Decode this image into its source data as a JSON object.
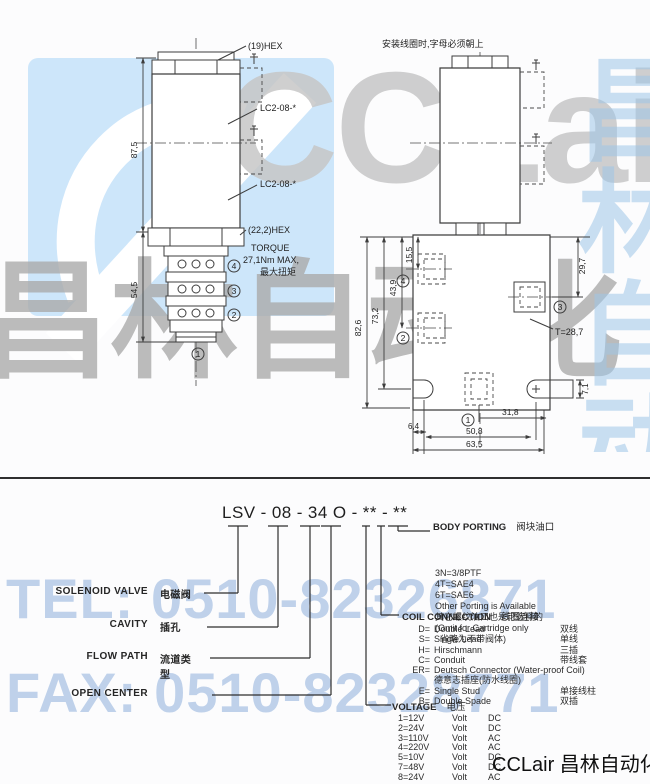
{
  "watermark": {
    "brand_latin": "CCLair",
    "brand_cn": "昌林自动化",
    "tel": "TEL: 0510-82326871",
    "fax": "FAX: 0510-82328771",
    "footer_brand": "CCLair 昌林自动化",
    "colors": {
      "logo_blue": "#cde6fa",
      "gray": "#c7c7c7",
      "blue_text": "#b9cde9"
    }
  },
  "drawings": {
    "install_note": "安装线圈时,字母必须朝上",
    "left": {
      "hex_top": "(19)HEX",
      "cavity_label_1": "LC2-08-*",
      "cavity_label_2": "LC2-08-*",
      "dim_coil_height": "87,5",
      "dim_cartridge_height": "54,5",
      "hex_bottom": "(22,2)HEX",
      "torque_line1": "TORQUE",
      "torque_line2": "27,1Nm MAX,",
      "torque_line3": "最大扭矩",
      "port4": "4",
      "port3": "3",
      "port2": "2",
      "port1": "1"
    },
    "right": {
      "dim_total_height": "82,6",
      "dim_h2": "73,2",
      "dim_h3": "43,9",
      "dim_h4": "15,5",
      "dim_right_height": "29,7",
      "thread": "T=28,7",
      "dim_stub": "7,1",
      "dim_center": "31,8",
      "dim_holes": "50,8",
      "dim_width": "63,5",
      "dim_edge": "6,4",
      "port4": "4",
      "port3": "3",
      "port2": "2",
      "port1": "1"
    }
  },
  "model_code": {
    "segments": [
      "LSV",
      "-",
      "08",
      "-",
      "34",
      "O",
      "-",
      "**",
      "-",
      "**"
    ]
  },
  "code_labels": {
    "solenoid_valve": {
      "en": "SOLENOID VALVE",
      "cn": "电磁阀"
    },
    "cavity": {
      "en": "CAVITY",
      "cn": "插孔"
    },
    "flow_path": {
      "en": "FLOW PATH",
      "cn": "流道类型"
    },
    "open_center": {
      "en": "OPEN CENTER",
      "cn": ""
    }
  },
  "body_porting": {
    "title_en": "BODY PORTING",
    "title_cn": "阀块油口",
    "lines": [
      "3N=3/8PTF",
      "4T=SAE4",
      "6T=SAE6",
      "Other Porting is Available",
      "其它螺纹油口也是可选择的",
      "(Omit for Cartridge only",
      "  省略为不带阀体)"
    ]
  },
  "coil_connection": {
    "title_en": "COIL CONNECTION",
    "title_cn": "线圈连接",
    "rows": [
      {
        "c": "D=",
        "e": "Double Lead",
        "n": "双线"
      },
      {
        "c": "S=",
        "e": "Single Lead",
        "n": "单线"
      },
      {
        "c": "H=",
        "e": "Hirschmann",
        "n": "三插"
      },
      {
        "c": "C=",
        "e": "Conduit",
        "n": "带线套"
      },
      {
        "c": "ER=",
        "e": "Deutsch Connector (Water-proof Coil)",
        "n": ""
      },
      {
        "c": "",
        "e": "德意志插座(防水线圈)",
        "n": ""
      },
      {
        "c": "E=",
        "e": "Single Stud",
        "n": "单接线柱"
      },
      {
        "c": "B=",
        "e": "Double Spade",
        "n": "双插"
      }
    ]
  },
  "voltage": {
    "title_en": "VOLTAGE",
    "title_cn": "电压",
    "rows": [
      {
        "c": "1=12V",
        "v": "Volt",
        "t": "DC"
      },
      {
        "c": "2=24V",
        "v": "Volt",
        "t": "DC"
      },
      {
        "c": "3=110V",
        "v": "Volt",
        "t": "AC"
      },
      {
        "c": "4=220V",
        "v": "Volt",
        "t": "AC"
      },
      {
        "c": "5=10V",
        "v": "Volt",
        "t": "DC"
      },
      {
        "c": "7=48V",
        "v": "Volt",
        "t": "DC"
      },
      {
        "c": "8=24V",
        "v": "Volt",
        "t": "AC"
      }
    ]
  }
}
